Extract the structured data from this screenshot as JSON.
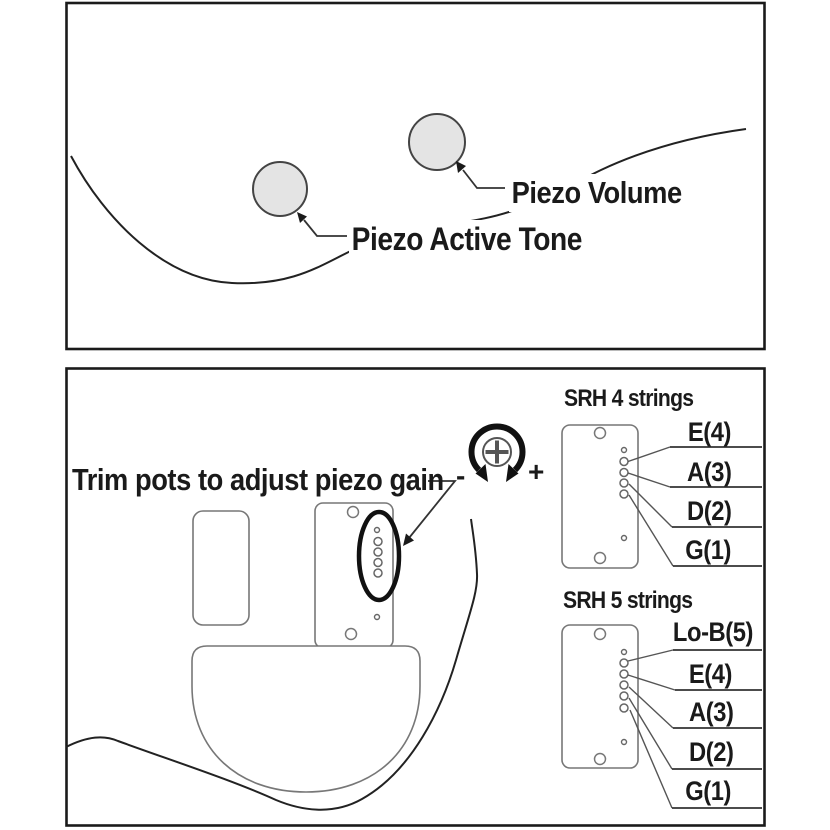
{
  "top_panel": {
    "piezo_volume_label": "Piezo Volume",
    "piezo_active_tone_label": "Piezo Active Tone"
  },
  "bottom_panel": {
    "trim_note": "Trim pots to adjust piezo gain",
    "gain_minus": "-",
    "gain_plus": "+",
    "srh4": {
      "title": "SRH 4 strings",
      "strings": [
        "E(4)",
        "A(3)",
        "D(2)",
        "G(1)"
      ]
    },
    "srh5": {
      "title": "SRH 5 strings",
      "strings": [
        "Lo-B(5)",
        "E(4)",
        "A(3)",
        "D(2)",
        "G(1)"
      ]
    }
  },
  "icons": {
    "rotate_adjust": "rotate-arrows-icon",
    "screw": "phillips-screw-icon"
  },
  "colors": {
    "ink": "#1a1a1a",
    "outline_gray": "#777777",
    "knob_fill": "#e4e4e4"
  }
}
